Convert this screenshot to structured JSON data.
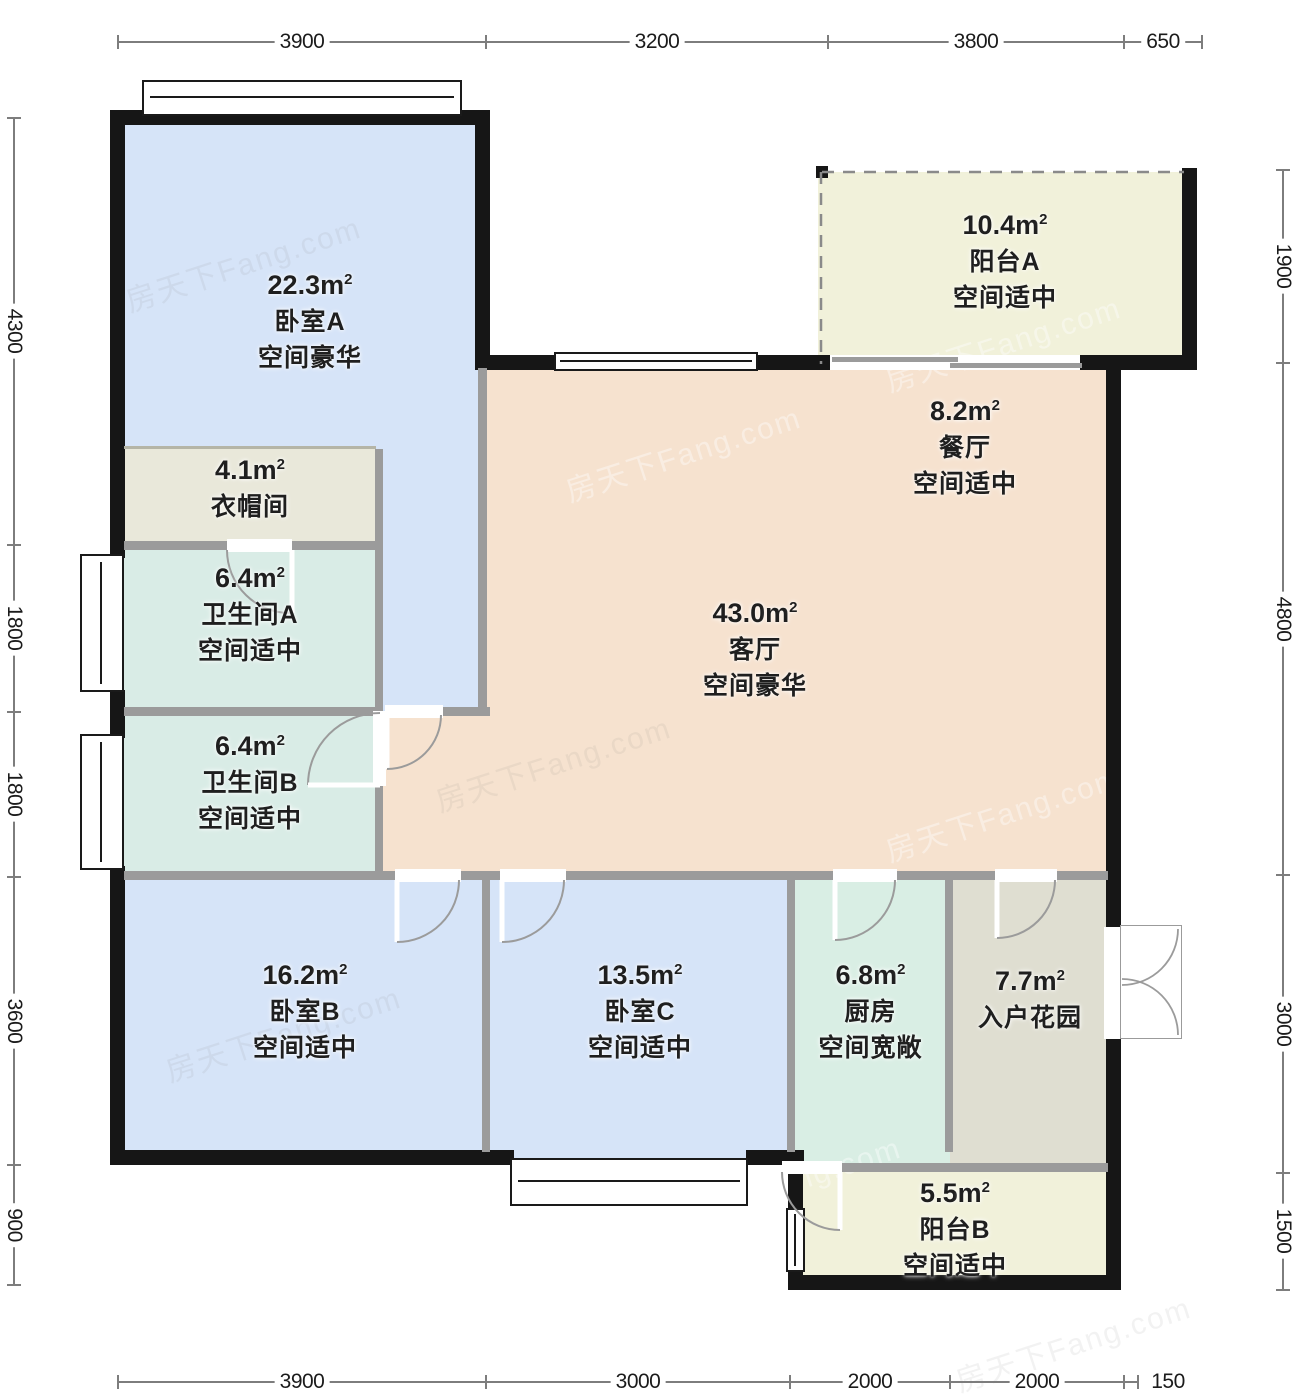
{
  "units": {
    "base": "m",
    "sup": "2"
  },
  "rooms": [
    {
      "id": "bedroom-a",
      "area": "22.3",
      "name": "卧室A",
      "desc": "空间豪华"
    },
    {
      "id": "closet",
      "area": "4.1",
      "name": "衣帽间",
      "desc": ""
    },
    {
      "id": "bathroom-a",
      "area": "6.4",
      "name": "卫生间A",
      "desc": "空间适中"
    },
    {
      "id": "bathroom-b",
      "area": "6.4",
      "name": "卫生间B",
      "desc": "空间适中"
    },
    {
      "id": "living",
      "area": "43.0",
      "name": "客厅",
      "desc": "空间豪华"
    },
    {
      "id": "dining",
      "area": "8.2",
      "name": "餐厅",
      "desc": "空间适中"
    },
    {
      "id": "balcony-a",
      "area": "10.4",
      "name": "阳台A",
      "desc": "空间适中"
    },
    {
      "id": "bedroom-b",
      "area": "16.2",
      "name": "卧室B",
      "desc": "空间适中"
    },
    {
      "id": "bedroom-c",
      "area": "13.5",
      "name": "卧室C",
      "desc": "空间适中"
    },
    {
      "id": "kitchen",
      "area": "6.8",
      "name": "厨房",
      "desc": "空间宽敞"
    },
    {
      "id": "garden",
      "area": "7.7",
      "name": "入户花园",
      "desc": ""
    },
    {
      "id": "balcony-b",
      "area": "5.5",
      "name": "阳台B",
      "desc": "空间适中"
    }
  ],
  "dims": {
    "top": [
      "3900",
      "3200",
      "3800",
      "650"
    ],
    "left": [
      "4300",
      "1800",
      "1800",
      "3600",
      "900"
    ],
    "right": [
      "1900",
      "4800",
      "3000",
      "1500"
    ],
    "bottom": [
      "3900",
      "3000",
      "2000",
      "2000",
      "150"
    ]
  },
  "watermark": "房天下Fang.com",
  "colors": {
    "blue": "#d6e4f8",
    "peach": "#f6e2cf",
    "teal": "#d9ece6",
    "mint": "#d9eee4",
    "tan": "#e9e8da",
    "sage": "#dfded1",
    "cream": "#f1f1da",
    "wall_black": "#161616",
    "wall_gray": "#9b9b9b"
  }
}
